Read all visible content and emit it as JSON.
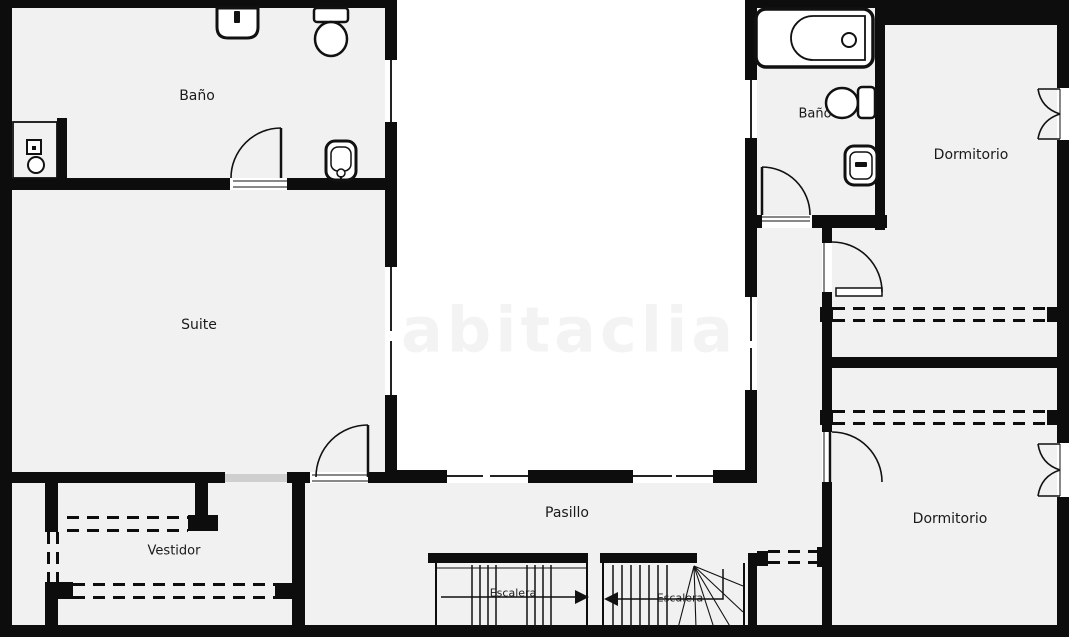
{
  "plan_title": "Planta - vivienda",
  "watermark": "habitaclia",
  "rooms": {
    "bano1": {
      "label": "Baño"
    },
    "suite": {
      "label": "Suite"
    },
    "vestidor": {
      "label": "Vestidor"
    },
    "pasillo": {
      "label": "Pasillo"
    },
    "escalera_left": {
      "label": "Escalera"
    },
    "escalera_right": {
      "label": "Escalera"
    },
    "bano2": {
      "label": "Baño"
    },
    "dormitorio1": {
      "label": "Dormitorio"
    },
    "dormitorio2": {
      "label": "Dormitorio"
    }
  },
  "fixtures": {
    "bano1": [
      "sink",
      "toilet",
      "shower",
      "bidet"
    ],
    "bano2": [
      "bathtub",
      "toilet",
      "washbasin"
    ]
  },
  "features": {
    "wardrobes_dashed": [
      "vestidor-top",
      "vestidor-bottom",
      "dormitorio1-closet",
      "dormitorio2-closet",
      "hall-closet"
    ],
    "stair_arrows": [
      "right",
      "left"
    ],
    "windows": [
      "patio-left-top",
      "patio-left-suite",
      "patio-right-top",
      "patio-right-mid",
      "patio-bottom-1",
      "patio-bottom-2",
      "exterior-right-top",
      "exterior-right-bottom"
    ],
    "sliding_door": "suite-vestidor"
  },
  "colors": {
    "wall": "#0d0d0d",
    "room": "#f1f1f1",
    "bg": "#ffffff",
    "slide": "#cfcfcf",
    "text": "#1a1a1a"
  }
}
